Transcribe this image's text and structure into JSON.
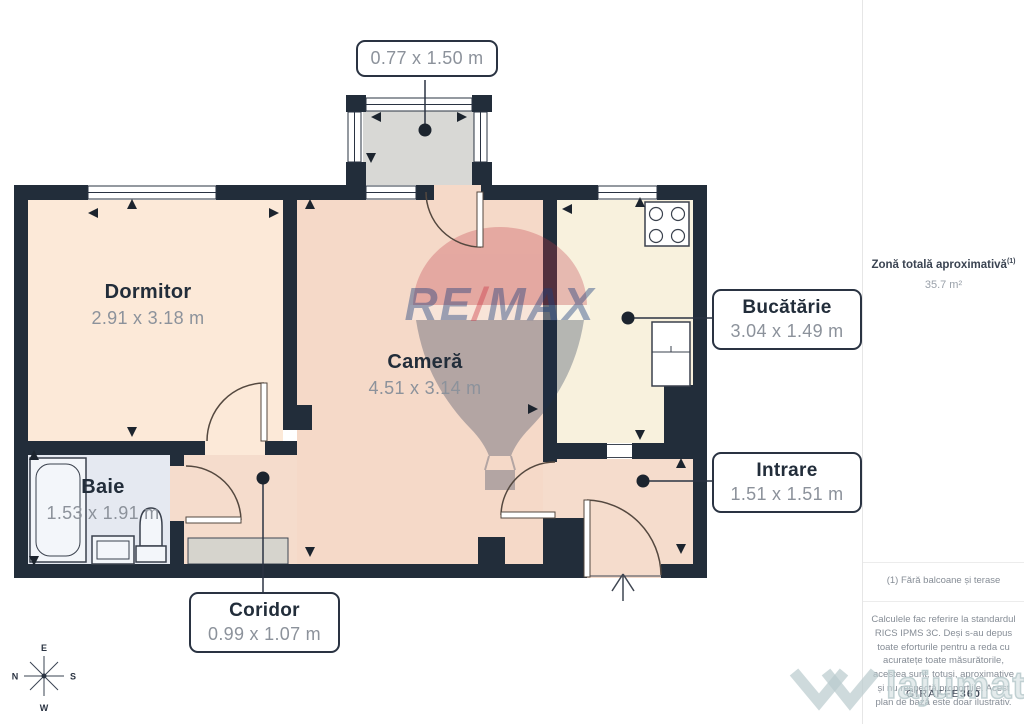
{
  "plan": {
    "rooms": {
      "dormitor": {
        "name": "Dormitor",
        "dims": "2.91 x 3.18 m"
      },
      "camera": {
        "name": "Cameră",
        "dims": "4.51 x 3.14 m"
      },
      "baie": {
        "name": "Baie",
        "dims": "1.53 x 1.91 m"
      },
      "bucatarie": {
        "name": "Bucătărie",
        "dims": "3.04 x 1.49 m"
      },
      "intrare": {
        "name": "Intrare",
        "dims": "1.51 x 1.51 m"
      },
      "coridor": {
        "name": "Coridor",
        "dims": "0.99 x 1.07 m"
      },
      "balcon": {
        "dims": "0.77 x 1.50 m"
      }
    },
    "colors": {
      "wall": "#222d3a",
      "dormitor": "#fce9d8",
      "camera": "#f5d9c8",
      "baie": "#e5e9f1",
      "bucatarie": "#f8f1dd",
      "hol": "#f5dccc",
      "balcon": "#d8d8d5",
      "accent_teal": "#36c4c8"
    }
  },
  "sidebar": {
    "total_area_label": "Zonă totală aproximativă",
    "total_area_note_ref": "(1)",
    "total_area_value": "35.7 m²",
    "footnote": "(1) Fără balcoane și terase",
    "disclaimer": "Calculele fac referire la standardul RICS IPMS 3C. Deși s-au depus toate eforturile pentru a reda cu acuratețe toate măsurătorile, acestea sunt, totuși, aproximative și nu respectă proporțiile. Acest plan de bază este doar ilustrativ.",
    "brand": "GIRAFFE",
    "brand_suffix": "360"
  },
  "compass": {
    "top": "E",
    "left": "N",
    "right": "S",
    "bottom": "W"
  },
  "watermarks": {
    "remax_re": "RE",
    "remax_slash": "/",
    "remax_max": "MAX",
    "lajumate_text": "lajumate",
    "lajumate_tld": ".ro"
  }
}
